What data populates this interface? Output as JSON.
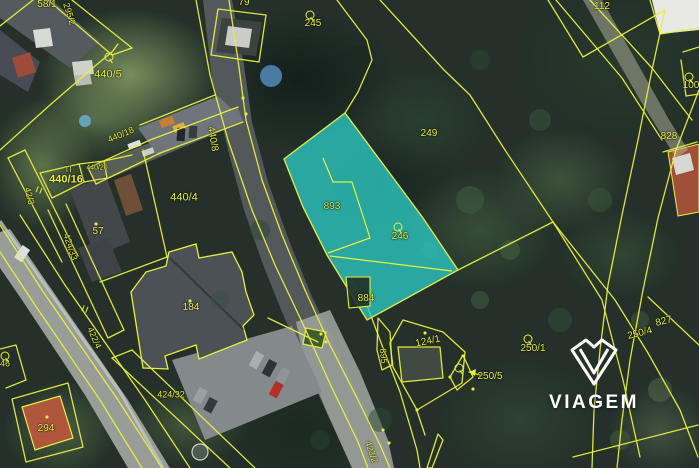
{
  "map_overlay": {
    "watermark_brand": "VIAGEM",
    "highlighted_parcels": [
      "893",
      "246",
      "884"
    ],
    "colors": {
      "boundary_line": "#e8ef3e",
      "label_text": "#e8ef3e",
      "highlight_fill": "#2cc9c3",
      "highlight_outline": "#d8e84c",
      "highlight_label": "#c6e84e",
      "watermark_color": "#ffffff"
    },
    "labels": [
      {
        "text": "58/1",
        "x": 47,
        "y": 5,
        "rot": 0,
        "size": 10
      },
      {
        "text": "295/2",
        "x": 69,
        "y": 14,
        "rot": 72,
        "size": 9
      },
      {
        "text": "440/5",
        "x": 108,
        "y": 75,
        "rot": 0,
        "size": 11
      },
      {
        "text": "79",
        "x": 244,
        "y": 3,
        "rot": 0,
        "size": 10
      },
      {
        "text": "245",
        "x": 313,
        "y": 24,
        "rot": 0,
        "size": 10
      },
      {
        "text": "112",
        "x": 602,
        "y": 7,
        "rot": 0,
        "size": 10
      },
      {
        "text": "100",
        "x": 691,
        "y": 86,
        "rot": 0,
        "size": 10
      },
      {
        "text": "828",
        "x": 669,
        "y": 137,
        "rot": 0,
        "size": 10
      },
      {
        "text": "249",
        "x": 429,
        "y": 134,
        "rot": 0,
        "size": 10
      },
      {
        "text": "440/18",
        "x": 121,
        "y": 135,
        "rot": -23,
        "size": 9
      },
      {
        "text": "440/16",
        "x": 66,
        "y": 180,
        "rot": 0,
        "size": 11,
        "bold": true
      },
      {
        "text": "440/20",
        "x": 97,
        "y": 168,
        "rot": 0,
        "size": 7
      },
      {
        "text": "42/3",
        "x": 29,
        "y": 196,
        "rot": 76,
        "size": 9
      },
      {
        "text": "440/4",
        "x": 184,
        "y": 198,
        "rot": 0,
        "size": 11
      },
      {
        "text": "440/8",
        "x": 212,
        "y": 139,
        "rot": 80,
        "size": 10
      },
      {
        "text": "57",
        "x": 98,
        "y": 232,
        "rot": 0,
        "size": 10
      },
      {
        "text": "424/33",
        "x": 70,
        "y": 247,
        "rot": 72,
        "size": 9
      },
      {
        "text": "184",
        "x": 191,
        "y": 308,
        "rot": 0,
        "size": 10
      },
      {
        "text": "422/4",
        "x": 94,
        "y": 338,
        "rot": 66,
        "size": 9
      },
      {
        "text": "424/32",
        "x": 171,
        "y": 395,
        "rot": 0,
        "size": 9
      },
      {
        "text": "294",
        "x": 46,
        "y": 429,
        "rot": 0,
        "size": 10
      },
      {
        "text": "46",
        "x": 5,
        "y": 364,
        "rot": 0,
        "size": 9
      },
      {
        "text": "893",
        "x": 332,
        "y": 207,
        "rot": 0,
        "size": 10,
        "color": "#c6e84e"
      },
      {
        "text": "246",
        "x": 400,
        "y": 237,
        "rot": 0,
        "size": 10
      },
      {
        "text": "884",
        "x": 366,
        "y": 299,
        "rot": 0,
        "size": 10
      },
      {
        "text": "895",
        "x": 383,
        "y": 356,
        "rot": 84,
        "size": 9
      },
      {
        "text": "124/1",
        "x": 428,
        "y": 342,
        "rot": -12,
        "size": 10
      },
      {
        "text": "250/1",
        "x": 533,
        "y": 349,
        "rot": 0,
        "size": 10
      },
      {
        "text": "250/5",
        "x": 490,
        "y": 377,
        "rot": 0,
        "size": 10
      },
      {
        "text": "250/4",
        "x": 640,
        "y": 334,
        "rot": -14,
        "size": 10
      },
      {
        "text": "827",
        "x": 664,
        "y": 322,
        "rot": -14,
        "size": 10
      },
      {
        "text": "423/2",
        "x": 371,
        "y": 452,
        "rot": 70,
        "size": 9
      }
    ],
    "circle_markers": [
      {
        "x": 109,
        "y": 57
      },
      {
        "x": 310,
        "y": 15
      },
      {
        "x": 689,
        "y": 77
      },
      {
        "x": 398,
        "y": 227
      },
      {
        "x": 528,
        "y": 339
      },
      {
        "x": 459,
        "y": 368
      },
      {
        "x": 5,
        "y": 356
      }
    ],
    "point_markers": [
      {
        "x": 243,
        "y": 98
      },
      {
        "x": 246,
        "y": 114
      },
      {
        "x": 96,
        "y": 224
      },
      {
        "x": 190,
        "y": 301
      },
      {
        "x": 47,
        "y": 417
      },
      {
        "x": 425,
        "y": 333
      },
      {
        "x": 463,
        "y": 356
      },
      {
        "x": 473,
        "y": 389
      },
      {
        "x": 450,
        "y": 377
      },
      {
        "x": 321,
        "y": 334
      },
      {
        "x": 326,
        "y": 342
      },
      {
        "x": 383,
        "y": 430
      },
      {
        "x": 389,
        "y": 443
      },
      {
        "x": 417,
        "y": 410
      }
    ],
    "tick_markers": [
      {
        "x": 39,
        "y": 190
      },
      {
        "x": 85,
        "y": 309
      }
    ],
    "utility_marker": {
      "text": "TI",
      "x": 68,
      "y": 170
    }
  }
}
